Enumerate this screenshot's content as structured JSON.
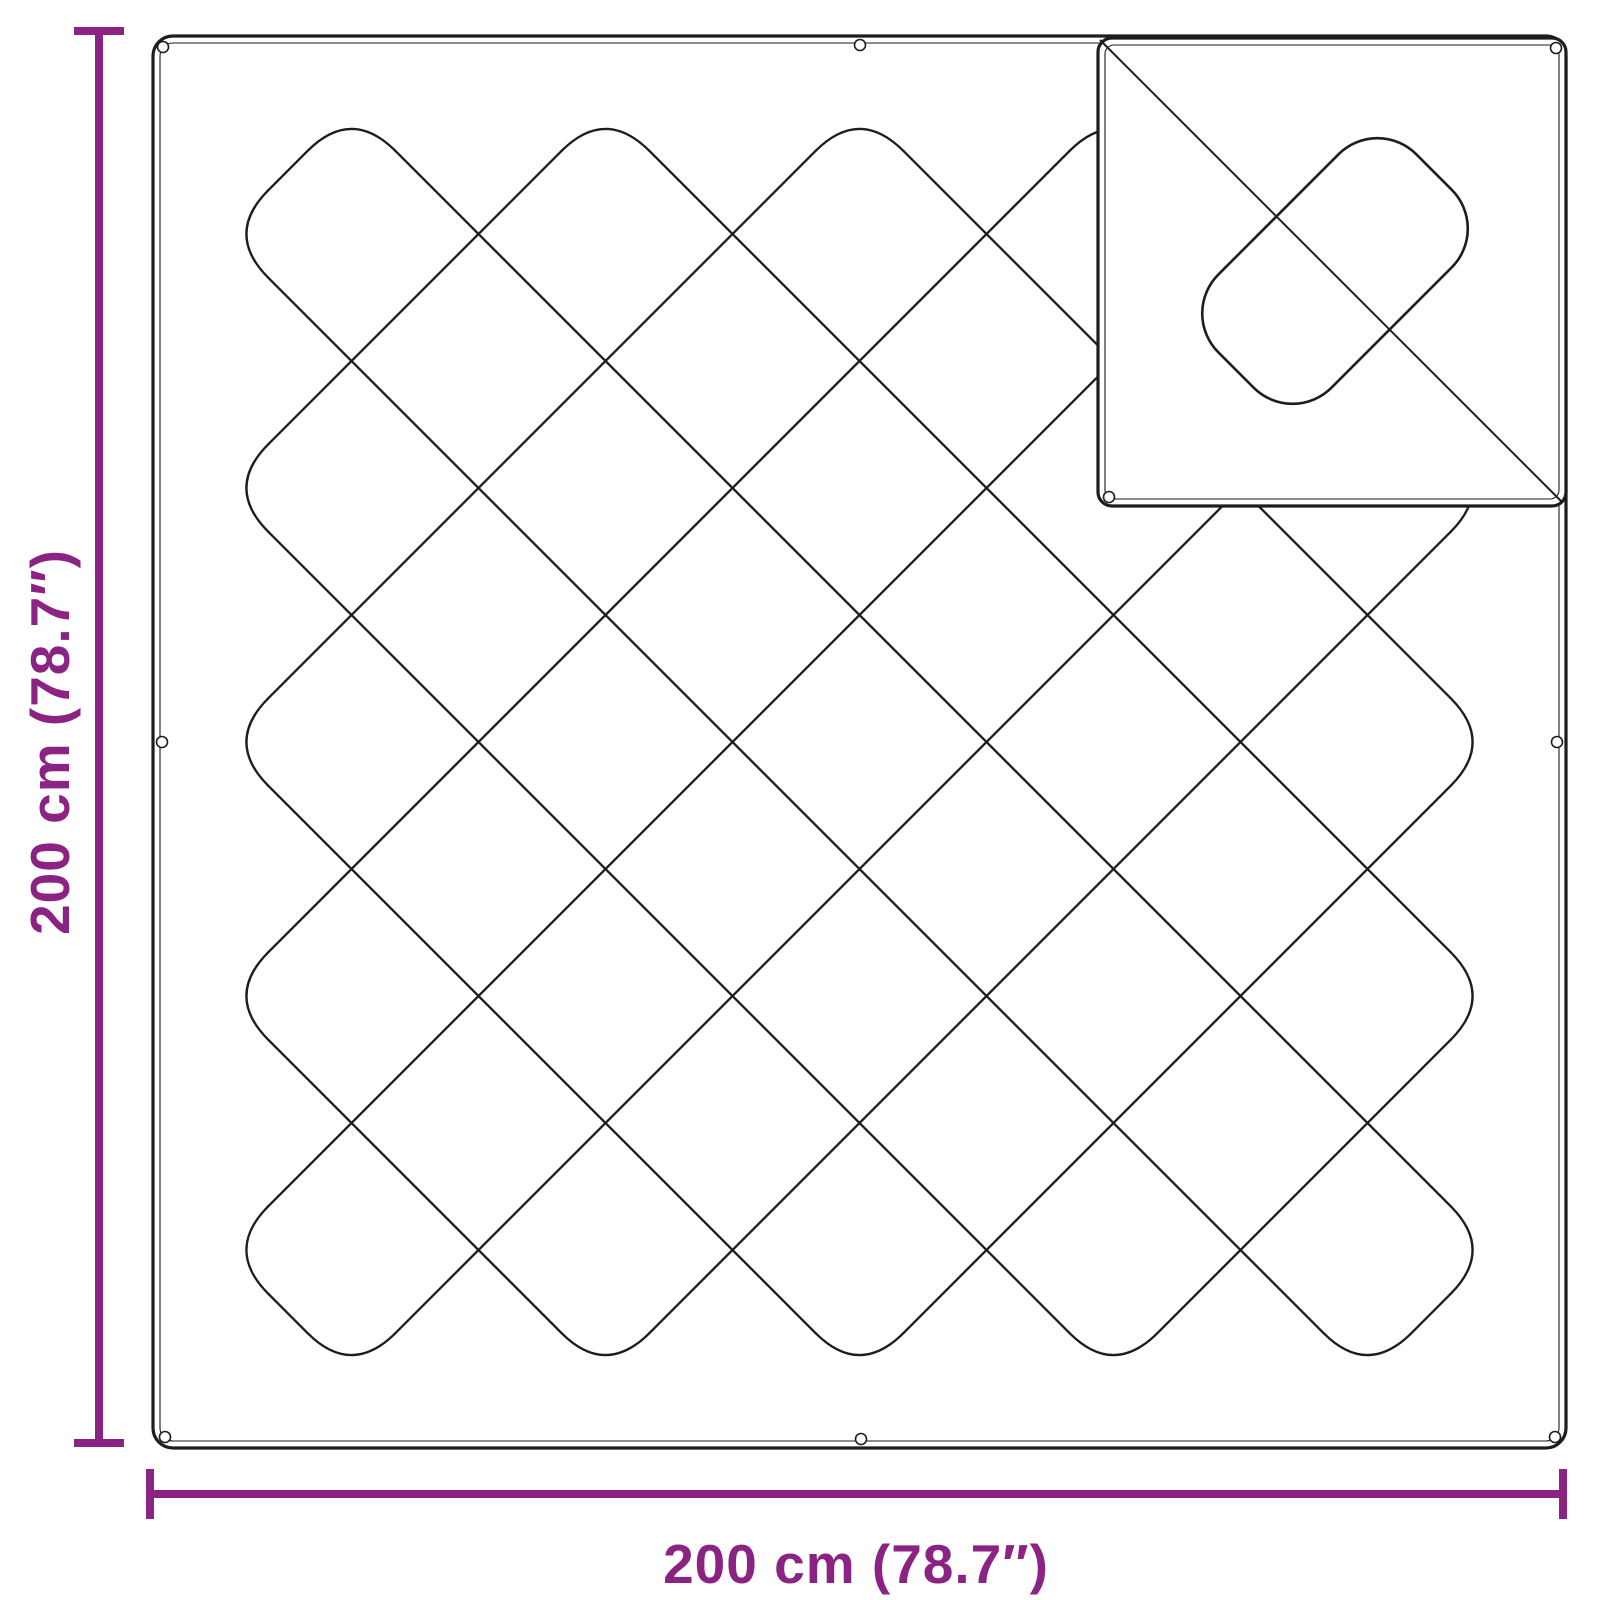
{
  "page": {
    "background_color": "#ffffff"
  },
  "dimensions": {
    "width_label": "200 cm (78.7″)",
    "height_label": "200 cm (78.7″)",
    "accent_color": "#8B2383"
  },
  "diagram": {
    "type": "product-dimension-diagram",
    "line_color": "#1d1d1d",
    "tarp": {
      "x": 153,
      "y": 36,
      "w": 1413,
      "h": 1412,
      "rx": 20,
      "inset": 7,
      "outer_stroke": 3.2,
      "inner_stroke": 1.1
    },
    "quilt": {
      "spacing": 127,
      "extent": 5,
      "turn_radius": 62,
      "stroke_width": 2.3
    },
    "flap": {
      "x": 1098,
      "y": 38,
      "w": 468,
      "h": 468,
      "rx": 14,
      "inset": 7,
      "outer_stroke": 3.2,
      "inner_stroke": 1.1,
      "diagonal_stroke": 2,
      "diamond": {
        "cx": 1335,
        "cy": 271,
        "half_length": 140,
        "half_width": 80,
        "corner_radius": 55,
        "stroke_width": 2.6
      }
    },
    "grommets": {
      "r": 5.5,
      "stroke_width": 1.6,
      "main": [
        [
          163,
          47
        ],
        [
          860,
          45
        ],
        [
          162,
          742
        ],
        [
          1557,
          742
        ],
        [
          165,
          1437
        ],
        [
          861,
          1439
        ],
        [
          1555,
          1437
        ]
      ],
      "flap": [
        [
          1556,
          48
        ],
        [
          1109,
          497
        ]
      ]
    },
    "dim": {
      "stroke": 8,
      "cap_half": 25,
      "vertical": {
        "x": 99,
        "y1": 31,
        "y2": 1443
      },
      "horizontal": {
        "y": 1494,
        "x1": 150,
        "x2": 1563
      }
    }
  }
}
